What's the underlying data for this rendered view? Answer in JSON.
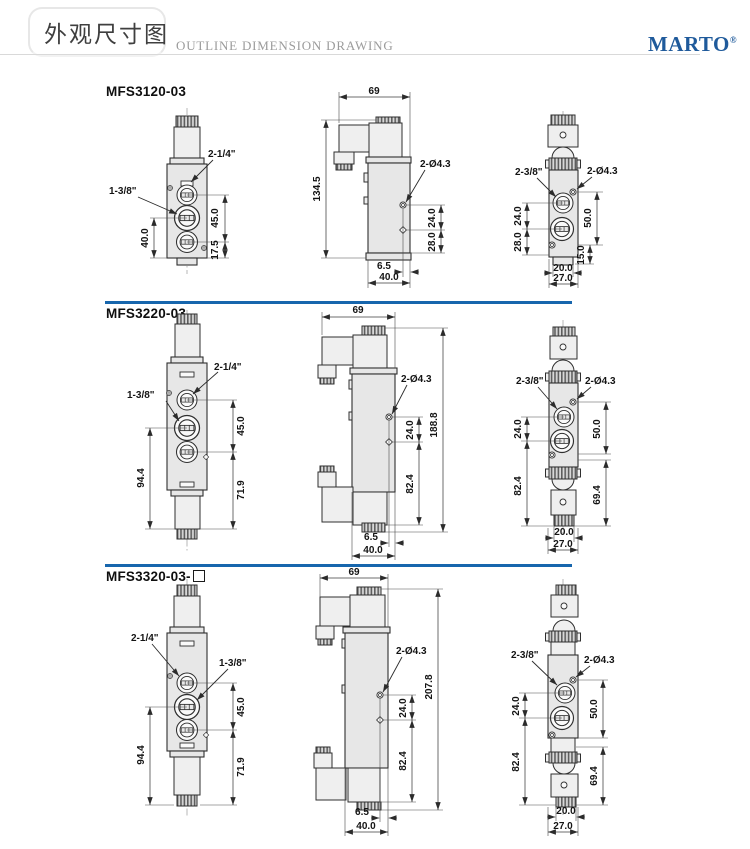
{
  "header": {
    "title_cn": "外观尺寸图",
    "title_en": "OUTLINE DIMENSION DRAWING",
    "brand": "MARTO",
    "registered_mark": "®"
  },
  "colors": {
    "divider_blue": "#1766ad",
    "brand_blue": "#1f5a9b",
    "body_fill": "#e7e7e7"
  },
  "sections": [
    {
      "model": "MFS3120-03",
      "front": {
        "port_label_a": "2-1/4\"",
        "port_label_b": "1-3/8\"",
        "dim_port_span": "45.0",
        "dim_left": "40.0",
        "dim_right_bottom": "17.5"
      },
      "side": {
        "dim_width": "69",
        "dim_total_height": "134.5",
        "hole_label": "2-Ø4.3",
        "dim_hole_spacing": "24.0",
        "dim_lower": "28.0",
        "dim_hole_edge": "6.5",
        "dim_body_depth": "40.0"
      },
      "rear": {
        "port_label": "2-3/8\"",
        "hole_label": "2-Ø4.3",
        "dim_left_upper": "24.0",
        "dim_left_lower": "28.0",
        "dim_right_upper": "50.0",
        "dim_right_lower": "15.0",
        "dim_bottom_inner": "20.0",
        "dim_bottom_outer": "27.0"
      }
    },
    {
      "model": "MFS3220-03",
      "front": {
        "port_label_a": "2-1/4\"",
        "port_label_b": "1-3/8\"",
        "dim_port_span": "45.0",
        "dim_left": "94.4",
        "dim_right_bottom": "71.9"
      },
      "side": {
        "dim_width": "69",
        "dim_total_height": "188.8",
        "hole_label": "2-Ø4.3",
        "dim_hole_spacing": "24.0",
        "dim_lower": "82.4",
        "dim_hole_edge": "6.5",
        "dim_body_depth": "40.0"
      },
      "rear": {
        "port_label": "2-3/8\"",
        "hole_label": "2-Ø4.3",
        "dim_left_upper": "24.0",
        "dim_left_lower": "82.4",
        "dim_right_upper": "50.0",
        "dim_right_lower": "69.4",
        "dim_bottom_inner": "20.0",
        "dim_bottom_outer": "27.0"
      }
    },
    {
      "model": "MFS3320-03-",
      "front": {
        "port_label_a": "2-1/4\"",
        "port_label_b": "1-3/8\"",
        "dim_port_span": "45.0",
        "dim_left": "94.4",
        "dim_right_bottom": "71.9"
      },
      "side": {
        "dim_width": "69",
        "dim_total_height": "207.8",
        "hole_label": "2-Ø4.3",
        "dim_hole_spacing": "24.0",
        "dim_lower": "82.4",
        "dim_hole_edge": "6.5",
        "dim_body_depth": "40.0"
      },
      "rear": {
        "port_label": "2-3/8\"",
        "hole_label": "2-Ø4.3",
        "dim_left_upper": "24.0",
        "dim_left_lower": "82.4",
        "dim_right_upper": "50.0",
        "dim_right_lower": "69.4",
        "dim_bottom_inner": "20.0",
        "dim_bottom_outer": "27.0"
      }
    }
  ]
}
